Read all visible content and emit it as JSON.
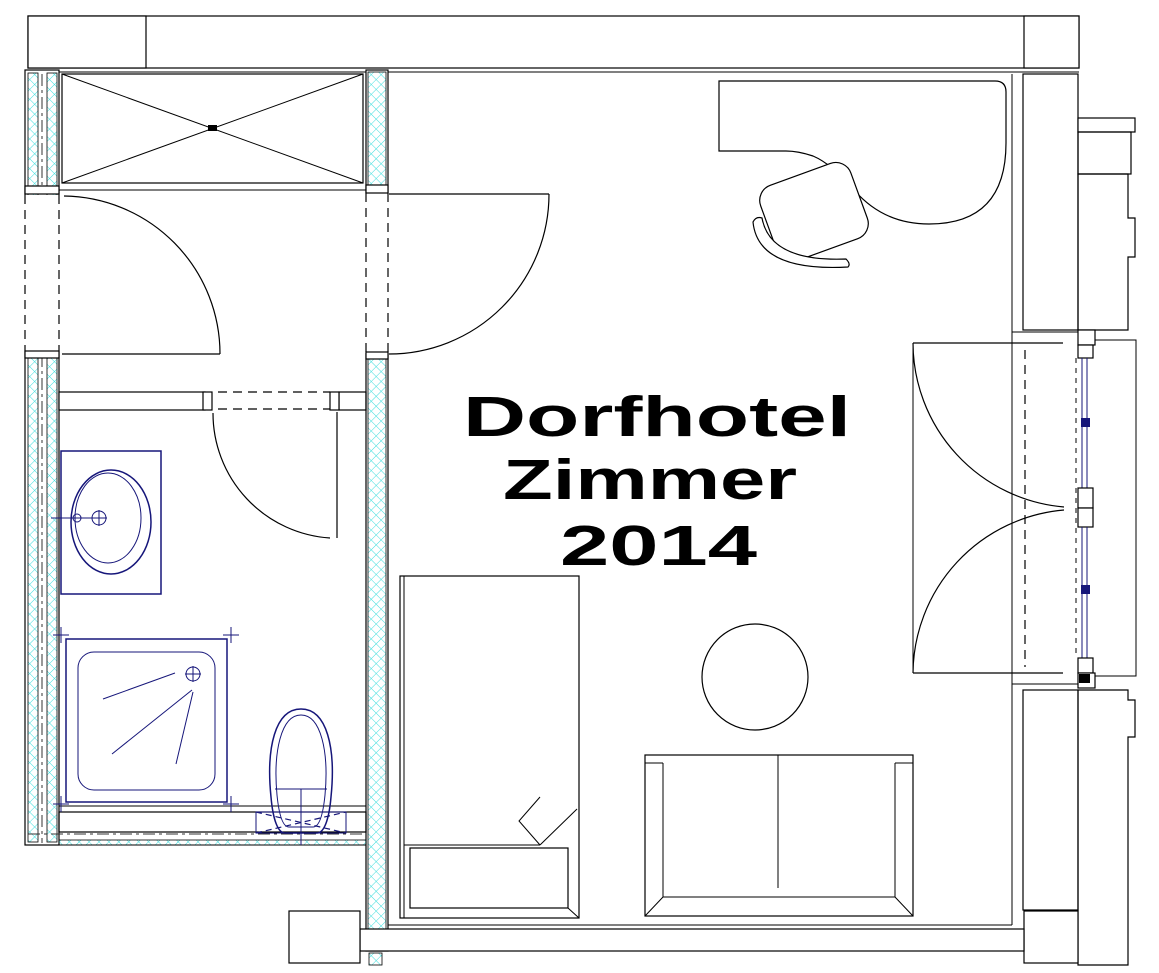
{
  "drawing": {
    "type": "architectural-floor-plan",
    "name": "Dorfhotel Zimmer 2014"
  },
  "title": {
    "line1": "Dorfhotel",
    "line2": "Zimmer",
    "line3": "2014",
    "full": "Dorfhotel Zimmer 2014"
  },
  "colors": {
    "masonry": "#8b3232",
    "insul": "#3fdede",
    "ext": "#c837c8",
    "anchor": "#2fa94f",
    "san": "#16167a",
    "line": "#000000",
    "background": "#ffffff"
  },
  "elements": [
    "masonry-wall-hatch",
    "insulated-partition-wall-hatch",
    "exterior-insulation-hatch",
    "anchor-block-hatch",
    "wardrobe",
    "hall-door",
    "room-entrance-door",
    "bathroom-door",
    "washbasin",
    "shower-tray",
    "toilet",
    "bed",
    "corner-desk",
    "desk-chair",
    "round-table",
    "sofa",
    "balcony-french-doors",
    "window-frame",
    "balcony-slab"
  ]
}
